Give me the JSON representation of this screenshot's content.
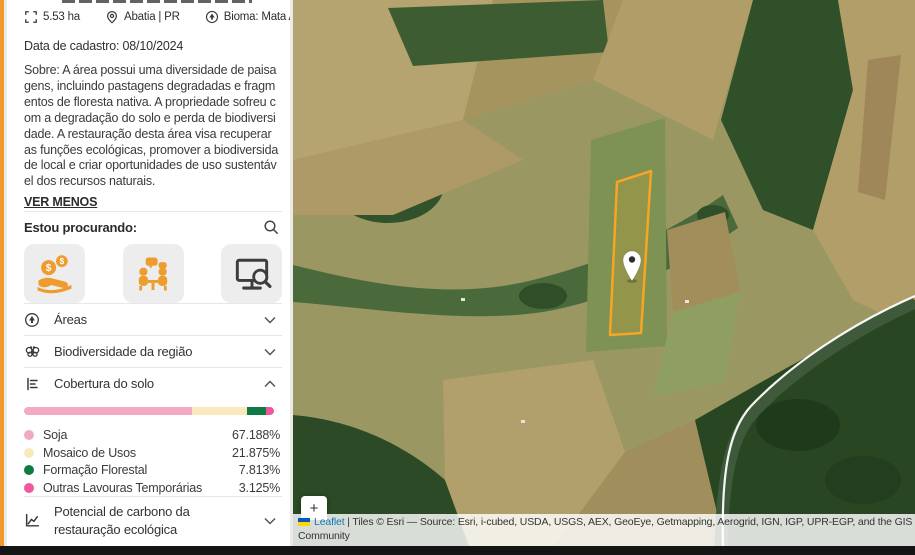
{
  "property": {
    "area": "5.53 ha",
    "location": "Abatia | PR",
    "biome": "Bioma: Mata Atlântica",
    "registration_date": "Data de cadastro: 08/10/2024",
    "about": "Sobre: A área possui uma diversidade de paisagens, incluindo pastagens degradadas e fragmentos de floresta nativa. A propriedade sofreu com a degradação do solo e perda de biodiversidade. A restauração desta área visa recuperar as funções ecológicas, promover a biodiversidade local e criar oportunidades de uso sustentável dos recursos naturais.",
    "collapse_link": "VER MENOS"
  },
  "search_section": {
    "title": "Estou procurando:",
    "options": [
      {
        "name": "financial-support"
      },
      {
        "name": "partnerships-meeting"
      },
      {
        "name": "monitoring-research"
      }
    ]
  },
  "sections": {
    "areas": {
      "label": "Áreas"
    },
    "biodiversity": {
      "label": "Biodiversidade da região"
    },
    "land_cover": {
      "label": "Cobertura do solo"
    },
    "carbon": {
      "label": "Potencial de carbono da restauração ecológica"
    }
  },
  "chart_data": {
    "type": "bar",
    "title": "Cobertura do solo",
    "categories": [
      "Soja",
      "Mosaico de Usos",
      "Formação Florestal",
      "Outras Lavouras Temporárias"
    ],
    "values": [
      67.188,
      21.875,
      7.813,
      3.125
    ],
    "unit": "%",
    "colors": [
      "#F2A9C2",
      "#FAE9BC",
      "#0E7B45",
      "#F2569E"
    ],
    "legend_position": "below-bar"
  },
  "land_cover_items": [
    {
      "label": "Soja",
      "value": "67.188%",
      "color": "#F2A9C2"
    },
    {
      "label": "Mosaico de Usos",
      "value": "21.875%",
      "color": "#FAE9BC"
    },
    {
      "label": "Formação Florestal",
      "value": "7.813%",
      "color": "#0E7B45"
    },
    {
      "label": "Outras Lavouras Temporárias",
      "value": "3.125%",
      "color": "#F2569E"
    }
  ],
  "map_ui": {
    "zoom_in_label": "+",
    "attribution_prefix": "Leaflet",
    "attribution_line1": " | Tiles © Esri — Source: Esri, i-cubed, USDA, USGS, AEX, GeoEye, Getmapping, Aerogrid, IGN, IGP, UPR-EGP, and the GIS User",
    "attribution_line2": "Community",
    "accent_color": "#F0982E"
  }
}
